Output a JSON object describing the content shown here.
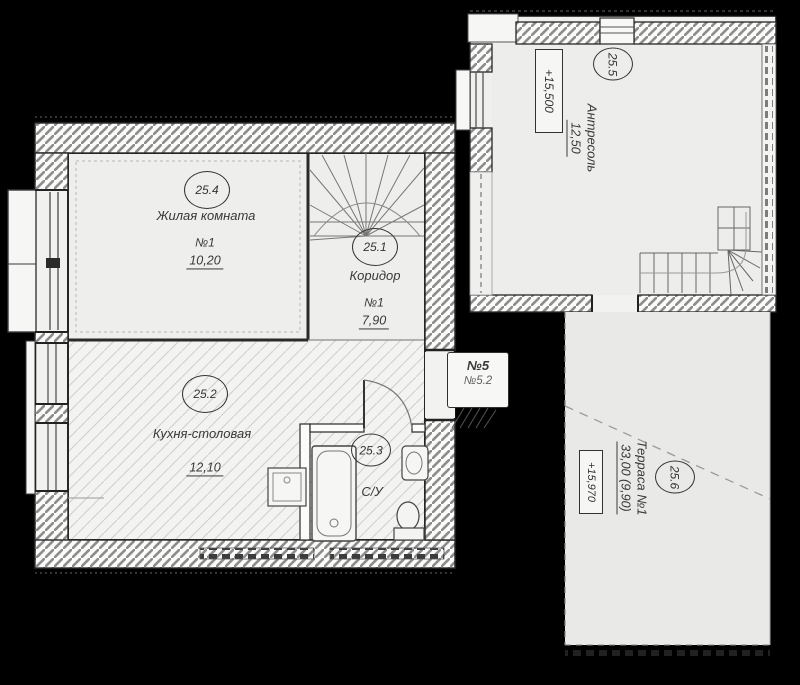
{
  "plan": {
    "rooms": {
      "living": {
        "number": "25.4",
        "name": "Жилая комната",
        "unit": "№1",
        "area": "10,20"
      },
      "corridor": {
        "number": "25.1",
        "name": "Коридор",
        "unit": "№1",
        "area": "7,90"
      },
      "kitchen": {
        "number": "25.2",
        "name": "Кухня-столовая",
        "area": "12,10"
      },
      "bathroom": {
        "number": "25.3",
        "name": "С/У"
      },
      "mezzanine": {
        "number": "25.5",
        "name": "Антресоль",
        "area": "12,50",
        "elevation": "+15,500"
      },
      "terrace": {
        "number": "25.6",
        "name": "Терраса №1",
        "area": "33,00 (9,90)",
        "elevation": "+15,970"
      }
    },
    "entrance_tag": {
      "line1": "№5",
      "line2": "№5.2"
    },
    "colors": {
      "background": "#000000",
      "paper": "#f1f1ef",
      "ink": "#2a2a2a",
      "wall_hatch": "#8d8d8d",
      "floor_hatch": "#cfcfcd"
    }
  }
}
